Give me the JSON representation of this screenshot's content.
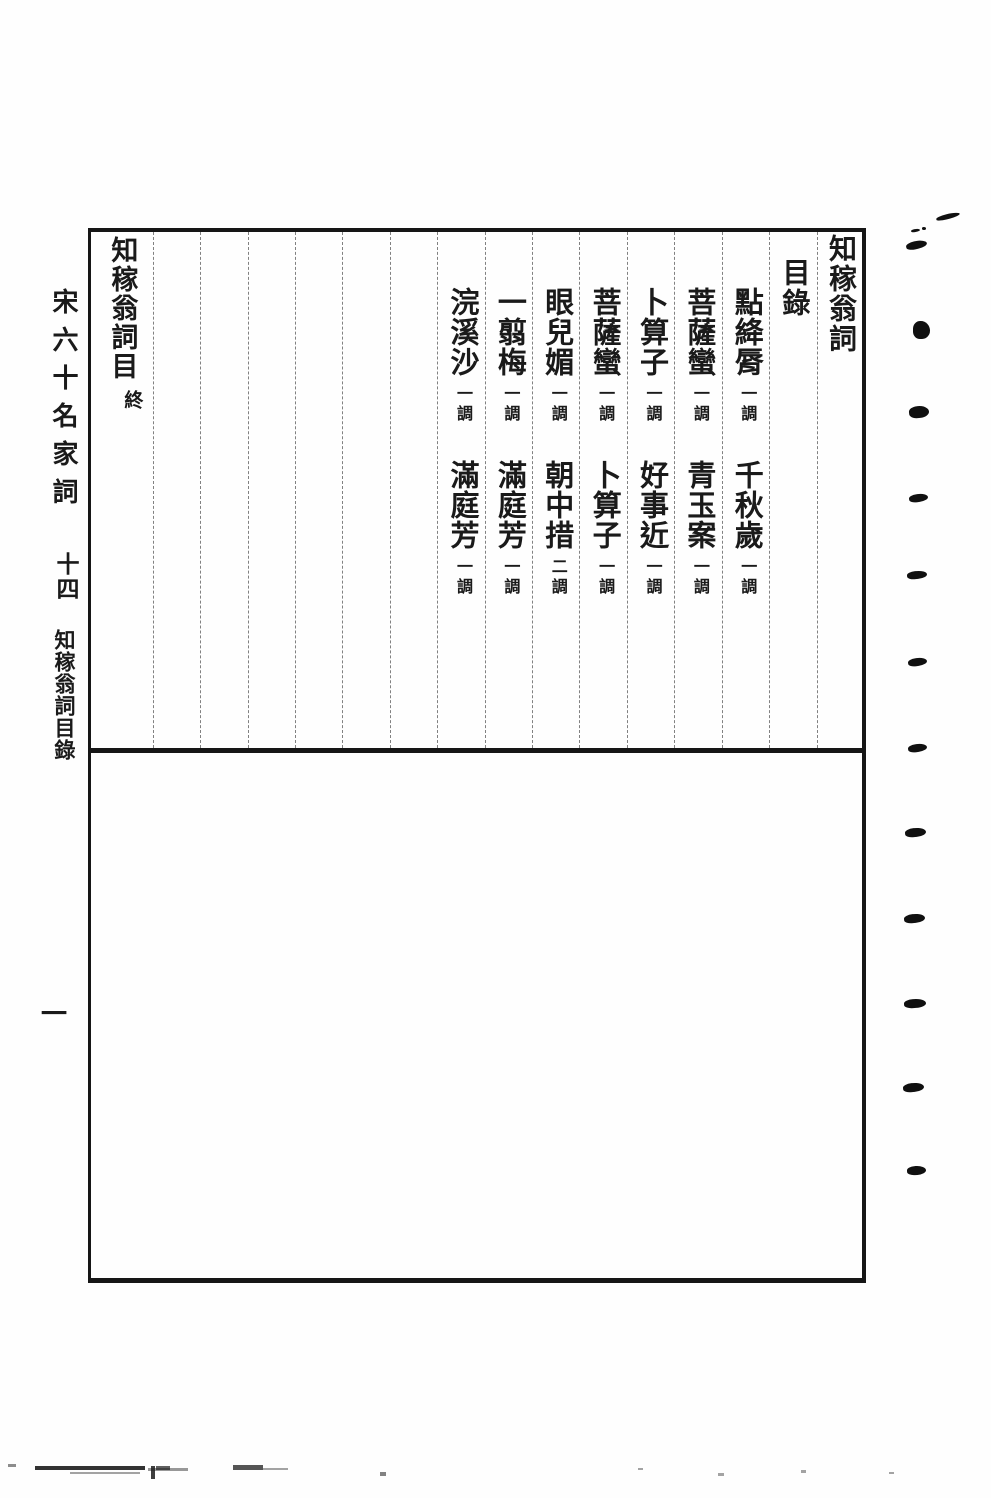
{
  "document": {
    "book_title": "知稼翁詞",
    "toc_heading": "目錄",
    "entries": [
      {
        "first": {
          "name": "點絳脣",
          "count": "一調"
        },
        "second": {
          "name": "千秋歲",
          "count": "一調"
        }
      },
      {
        "first": {
          "name": "菩薩蠻",
          "count": "一調"
        },
        "second": {
          "name": "青玉案",
          "count": "一調"
        }
      },
      {
        "first": {
          "name": "卜算子",
          "count": "一調"
        },
        "second": {
          "name": "好事近",
          "count": "一調"
        }
      },
      {
        "first": {
          "name": "菩薩蠻",
          "count": "一調"
        },
        "second": {
          "name": "卜算子",
          "count": "一調"
        }
      },
      {
        "first": {
          "name": "眼兒媚",
          "count": "一調"
        },
        "second": {
          "name": "朝中措",
          "count": "二調"
        }
      },
      {
        "first": {
          "name": "一翦梅",
          "count": "一調"
        },
        "second": {
          "name": "滿庭芳",
          "count": "一調"
        }
      },
      {
        "first": {
          "name": "浣溪沙",
          "count": "一調"
        },
        "second": {
          "name": "滿庭芳",
          "count": "一調"
        }
      }
    ],
    "empty_columns": 6,
    "end_column": {
      "text": "知稼翁詞目",
      "mark": "終"
    }
  },
  "left_margin": {
    "series_title": "宋六十名家詞",
    "volume": "十四",
    "section_title": "知稼翁詞目錄",
    "page_number": "一"
  },
  "right_margin": {
    "binding_marks": [
      {
        "x": 936,
        "y": 214,
        "w": 24,
        "h": 5,
        "r": -14
      },
      {
        "x": 911,
        "y": 229,
        "w": 9,
        "h": 3,
        "r": -10
      },
      {
        "x": 922,
        "y": 227,
        "w": 4,
        "h": 3,
        "r": 0
      },
      {
        "x": 906,
        "y": 241,
        "w": 21,
        "h": 8,
        "r": -12
      },
      {
        "x": 913,
        "y": 321,
        "w": 17,
        "h": 18,
        "r": 0
      },
      {
        "x": 909,
        "y": 406,
        "w": 20,
        "h": 12,
        "r": -6
      },
      {
        "x": 909,
        "y": 494,
        "w": 19,
        "h": 8,
        "r": -8
      },
      {
        "x": 907,
        "y": 571,
        "w": 20,
        "h": 8,
        "r": -6
      },
      {
        "x": 908,
        "y": 658,
        "w": 19,
        "h": 8,
        "r": -8
      },
      {
        "x": 908,
        "y": 744,
        "w": 19,
        "h": 8,
        "r": -8
      },
      {
        "x": 905,
        "y": 828,
        "w": 21,
        "h": 9,
        "r": -6
      },
      {
        "x": 904,
        "y": 914,
        "w": 21,
        "h": 9,
        "r": -6
      },
      {
        "x": 904,
        "y": 999,
        "w": 22,
        "h": 9,
        "r": -4
      },
      {
        "x": 903,
        "y": 1083,
        "w": 21,
        "h": 9,
        "r": -6
      },
      {
        "x": 907,
        "y": 1166,
        "w": 19,
        "h": 9,
        "r": -4
      }
    ]
  },
  "bottom_edge": {
    "scan_marks": [
      {
        "x": 8,
        "y": 1464,
        "w": 8,
        "h": 3,
        "o": 0.5
      },
      {
        "x": 35,
        "y": 1466,
        "w": 110,
        "h": 4,
        "o": 0.9
      },
      {
        "x": 70,
        "y": 1472,
        "w": 70,
        "h": 2,
        "o": 0.4
      },
      {
        "x": 148,
        "y": 1468,
        "w": 40,
        "h": 3,
        "o": 0.45
      },
      {
        "x": 151,
        "y": 1466,
        "w": 4,
        "h": 13,
        "o": 0.85
      },
      {
        "x": 156,
        "y": 1466,
        "w": 14,
        "h": 4,
        "o": 0.7
      },
      {
        "x": 233,
        "y": 1465,
        "w": 30,
        "h": 5,
        "o": 0.75
      },
      {
        "x": 263,
        "y": 1468,
        "w": 25,
        "h": 2,
        "o": 0.4
      },
      {
        "x": 380,
        "y": 1472,
        "w": 6,
        "h": 4,
        "o": 0.55
      },
      {
        "x": 638,
        "y": 1468,
        "w": 5,
        "h": 2,
        "o": 0.4
      },
      {
        "x": 718,
        "y": 1473,
        "w": 6,
        "h": 3,
        "o": 0.4
      },
      {
        "x": 801,
        "y": 1470,
        "w": 5,
        "h": 3,
        "o": 0.4
      },
      {
        "x": 889,
        "y": 1472,
        "w": 5,
        "h": 2,
        "o": 0.4
      }
    ]
  },
  "colors": {
    "ink": "#1a1a1a",
    "paper": "#fefefe"
  }
}
